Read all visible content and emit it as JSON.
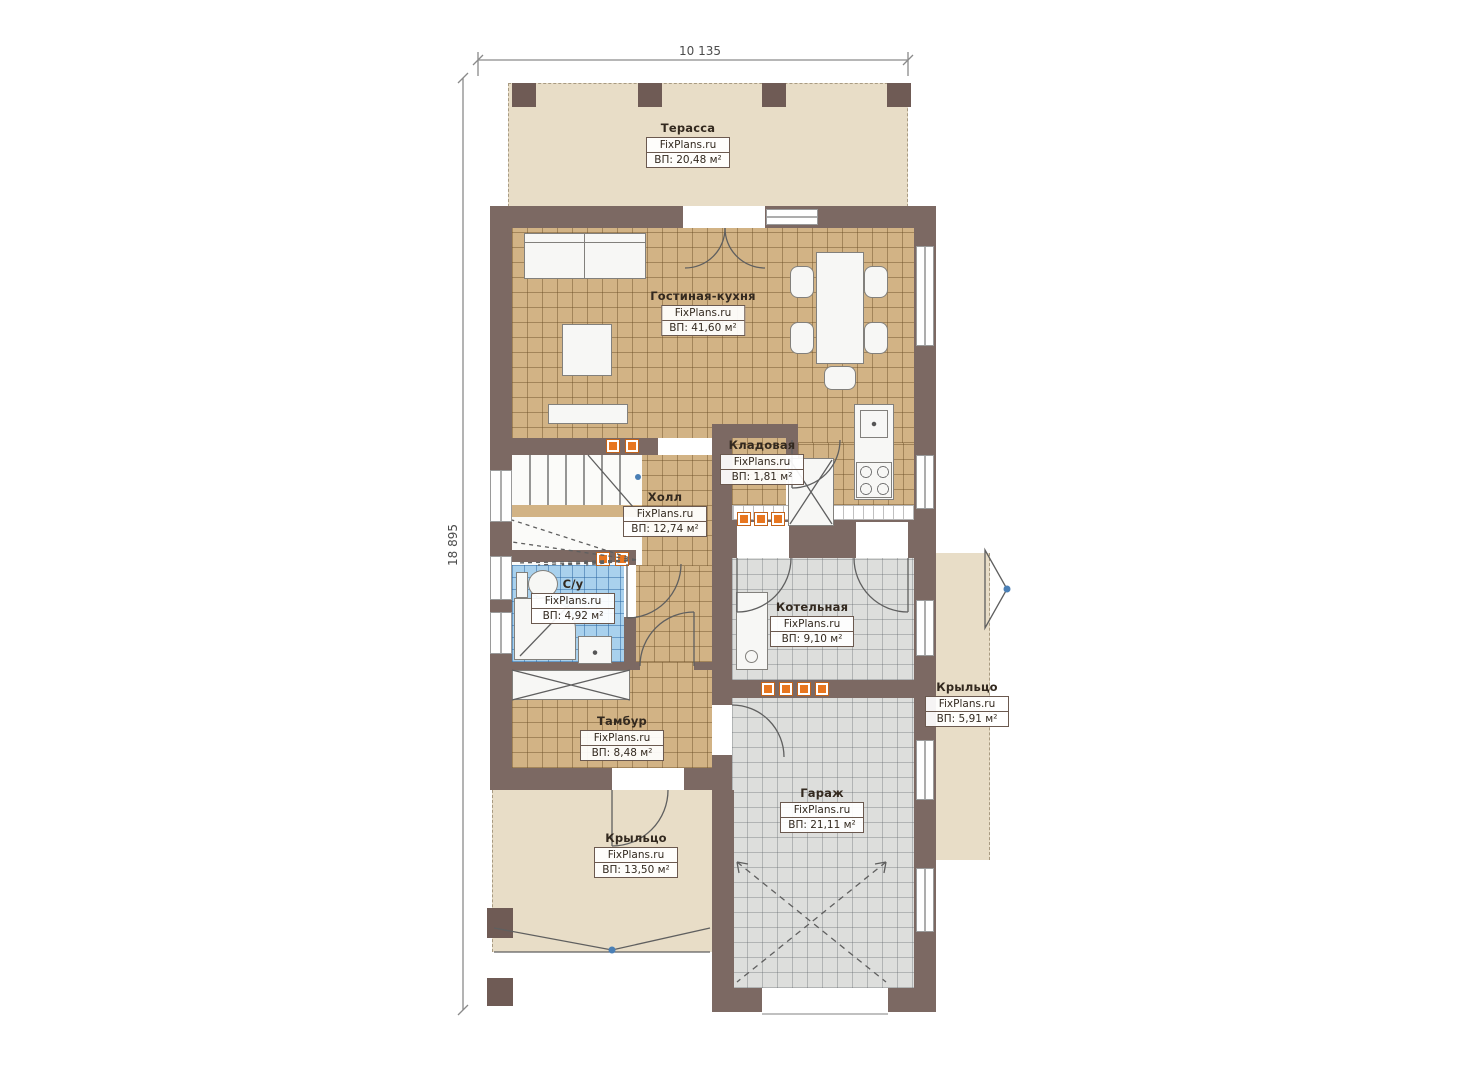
{
  "branding": {
    "site": "FixPlans.ru"
  },
  "dimensions": {
    "width_label": "10 135",
    "height_label": "18 895"
  },
  "rooms": {
    "terrace": {
      "name": "Терасса",
      "area": "ВП: 20,48 м²"
    },
    "living_kitchen": {
      "name": "Гостиная-кухня",
      "area": "ВП: 41,60 м²"
    },
    "pantry": {
      "name": "Кладовая",
      "area": "ВП: 1,81 м²"
    },
    "hall": {
      "name": "Холл",
      "area": "ВП: 12,74 м²"
    },
    "bathroom": {
      "name": "С/у",
      "area": "ВП: 4,92 м²"
    },
    "boiler": {
      "name": "Котельная",
      "area": "ВП: 9,10 м²"
    },
    "porch_right": {
      "name": "Крыльцо",
      "area": "ВП: 5,91 м²"
    },
    "vestibule": {
      "name": "Тамбур",
      "area": "ВП: 8,48 м²"
    },
    "garage": {
      "name": "Гараж",
      "area": "ВП: 21,11 м²"
    },
    "porch_front": {
      "name": "Крыльцо",
      "area": "ВП: 13,50 м²"
    }
  },
  "colors": {
    "wall": "#7c6963",
    "post": "#6f5b55",
    "tan": "#d2b385",
    "tan_line": "rgba(106,77,38,0.45)",
    "gray": "#dddedc",
    "gray_line": "rgba(95,100,105,0.35)",
    "blue": "#a9d1ed",
    "blue_line": "rgba(40,100,160,0.5)",
    "beige": "#e8ddc7",
    "furn": "#f7f7f5",
    "rad": "#e8761f",
    "marker": "#4a7fb5"
  }
}
